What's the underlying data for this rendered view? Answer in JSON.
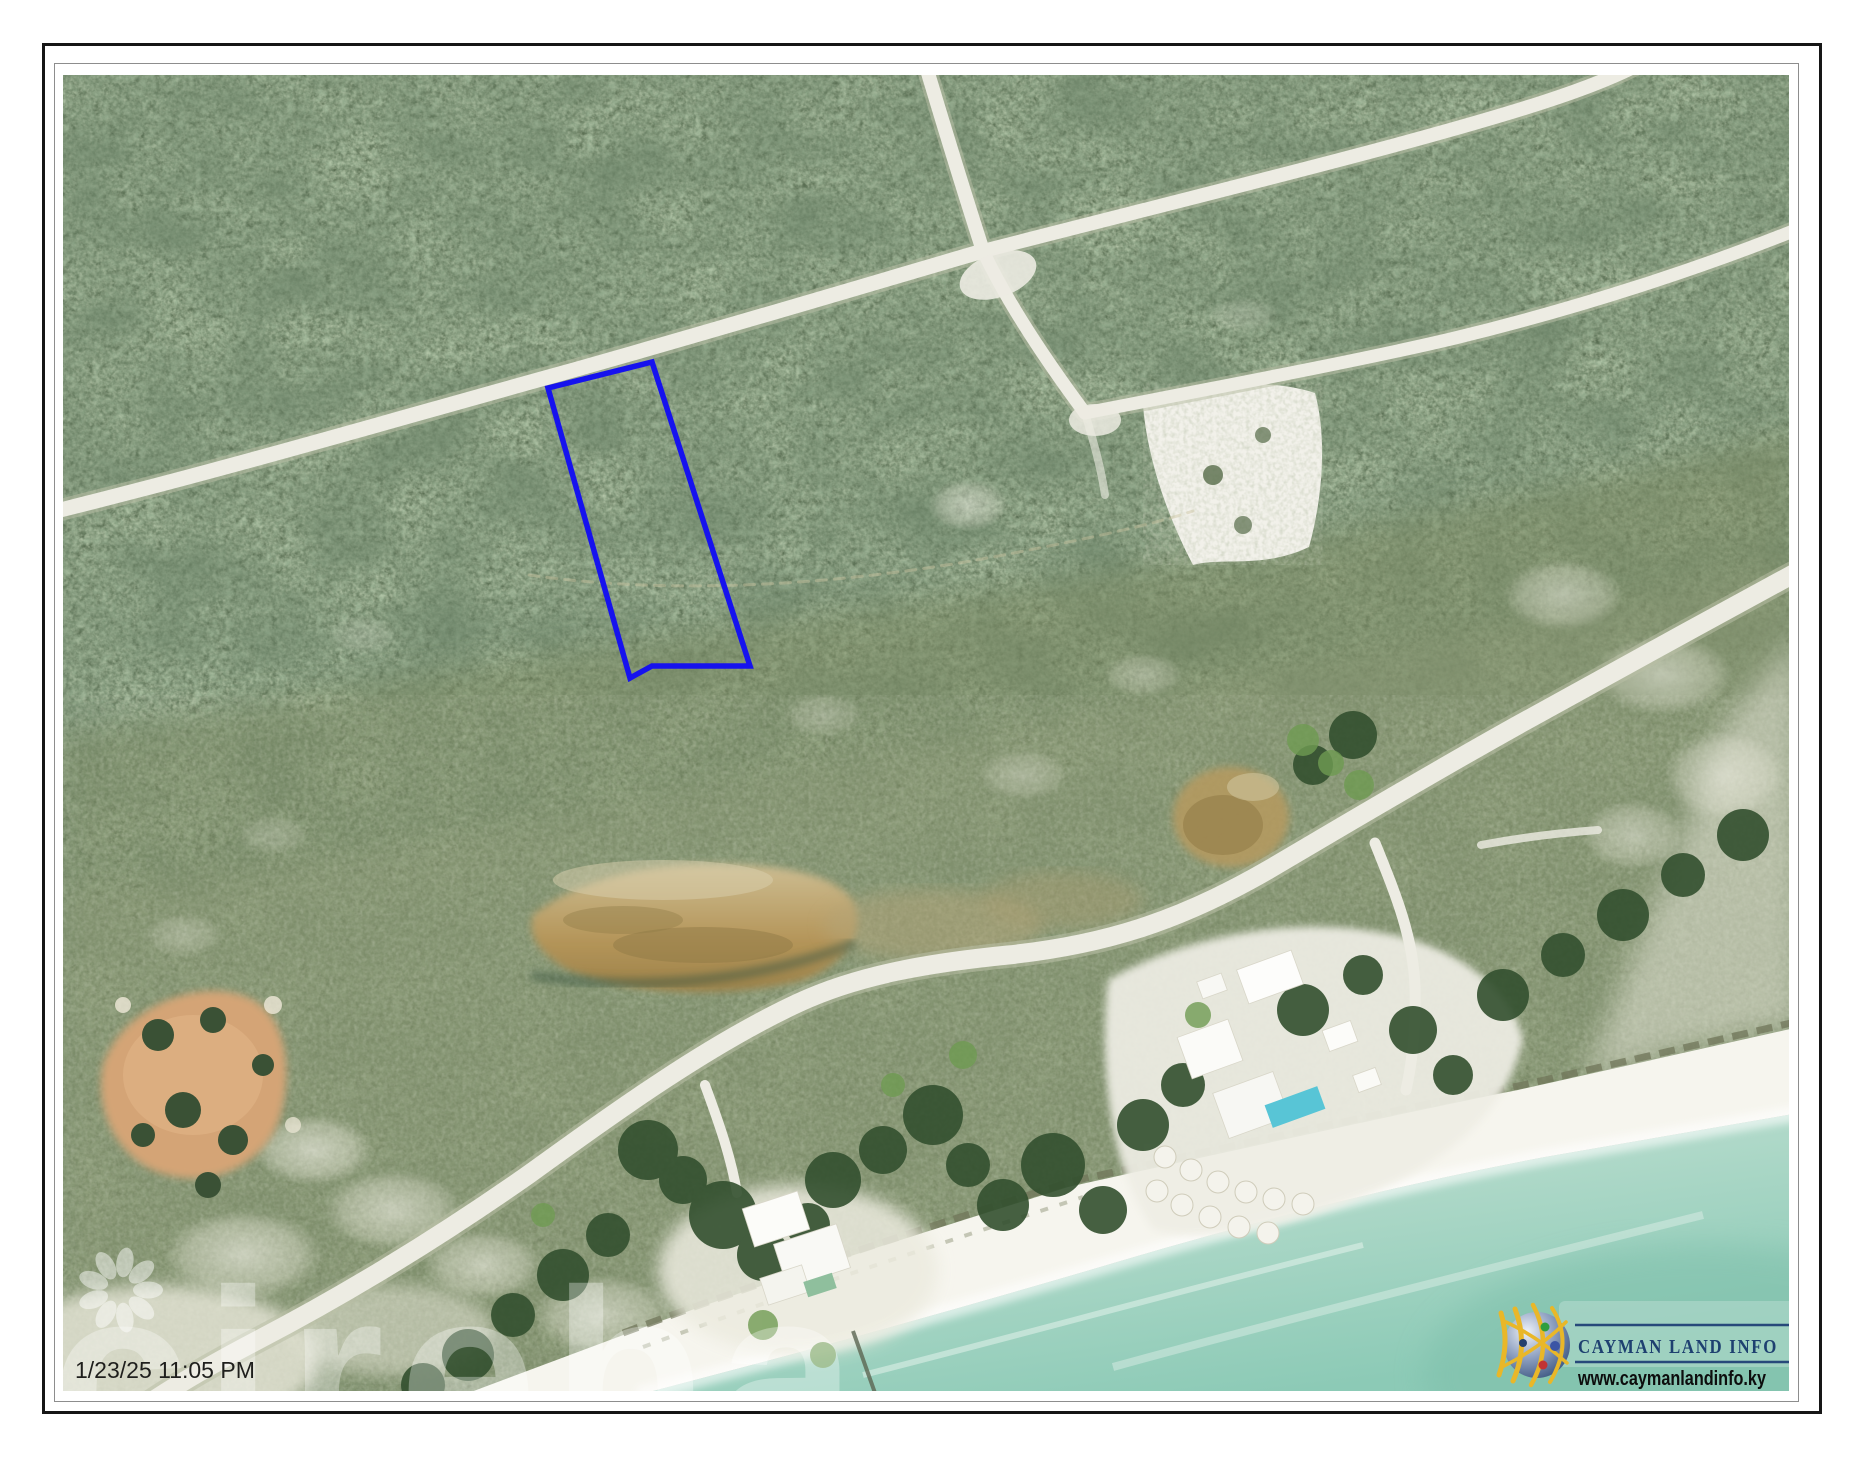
{
  "overlay": {
    "timestamp": "1/23/25 11:05 PM",
    "watermark_text": "cireba",
    "watermark_icon": "flower-rosette-icon",
    "watermark_color": "#ffffff"
  },
  "logo": {
    "title": "CAYMAN LAND INFO",
    "url": "www.caymanlandinfo.ky",
    "icon": "globe-network-icon",
    "title_color": "#1e4070",
    "url_color": "#0d0d0d",
    "line_color": "#27497a",
    "arc_color": "#e9b728"
  },
  "parcel": {
    "outline_color": "#1612ee"
  },
  "map": {
    "kind": "aerial-imagery",
    "sea_color": "#8ccab6",
    "forest_color": "#44573c",
    "road_color": "#edece3",
    "pond_color": "#b49559"
  }
}
